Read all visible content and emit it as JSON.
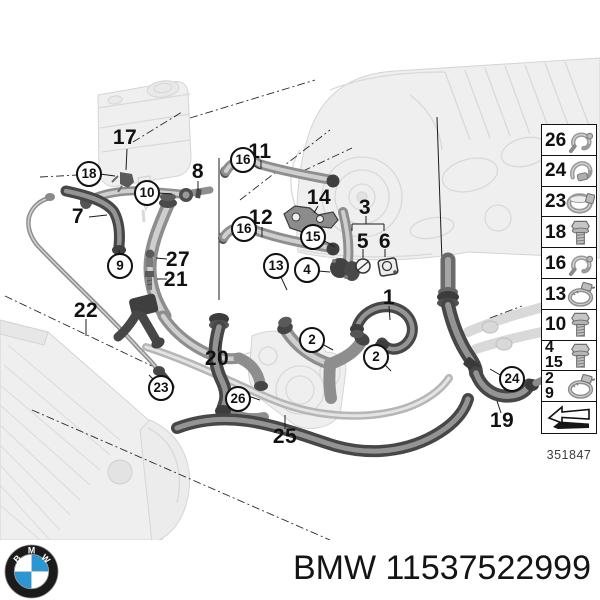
{
  "diagram": {
    "drawing_number": "351847",
    "callouts": [
      {
        "label": "17",
        "x": 125,
        "y": 138,
        "circled": false
      },
      {
        "label": "18",
        "x": 89,
        "y": 174,
        "circled": true
      },
      {
        "label": "10",
        "x": 147,
        "y": 193,
        "circled": true
      },
      {
        "label": "8",
        "x": 198,
        "y": 172,
        "circled": false
      },
      {
        "label": "7",
        "x": 78,
        "y": 217,
        "circled": false
      },
      {
        "label": "9",
        "x": 120,
        "y": 266,
        "circled": true
      },
      {
        "label": "27",
        "x": 178,
        "y": 260,
        "circled": false
      },
      {
        "label": "21",
        "x": 176,
        "y": 280,
        "circled": false
      },
      {
        "label": "22",
        "x": 86,
        "y": 311,
        "circled": false
      },
      {
        "label": "23",
        "x": 161,
        "y": 388,
        "circled": true
      },
      {
        "label": "20",
        "x": 217,
        "y": 359,
        "circled": false
      },
      {
        "label": "26",
        "x": 238,
        "y": 399,
        "circled": true
      },
      {
        "label": "25",
        "x": 285,
        "y": 437,
        "circled": false
      },
      {
        "label": "11",
        "x": 260,
        "y": 152,
        "circled": false
      },
      {
        "label": "16",
        "x": 243,
        "y": 160,
        "circled": true
      },
      {
        "label": "12",
        "x": 261,
        "y": 218,
        "circled": false
      },
      {
        "label": "16",
        "x": 244,
        "y": 229,
        "circled": true
      },
      {
        "label": "13",
        "x": 276,
        "y": 266,
        "circled": true
      },
      {
        "label": "14",
        "x": 319,
        "y": 198,
        "circled": false
      },
      {
        "label": "15",
        "x": 313,
        "y": 237,
        "circled": true
      },
      {
        "label": "3",
        "x": 365,
        "y": 208,
        "circled": false
      },
      {
        "label": "5",
        "x": 363,
        "y": 242,
        "circled": false
      },
      {
        "label": "6",
        "x": 385,
        "y": 242,
        "circled": false
      },
      {
        "label": "4",
        "x": 307,
        "y": 270,
        "circled": true
      },
      {
        "label": "1",
        "x": 389,
        "y": 298,
        "circled": false
      },
      {
        "label": "2",
        "x": 312,
        "y": 340,
        "circled": true
      },
      {
        "label": "2",
        "x": 376,
        "y": 357,
        "circled": true
      },
      {
        "label": "24",
        "x": 512,
        "y": 379,
        "circled": true
      },
      {
        "label": "19",
        "x": 502,
        "y": 421,
        "circled": false
      }
    ],
    "legend": {
      "boxes": [
        {
          "numbers": [
            "26"
          ],
          "icon": "retaining-clip-icon"
        },
        {
          "numbers": [
            "24"
          ],
          "icon": "mounting-clip-icon"
        },
        {
          "numbers": [
            "23"
          ],
          "icon": "hose-clamp-icon"
        },
        {
          "numbers": [
            "18"
          ],
          "icon": "bolt-icon"
        },
        {
          "numbers": [
            "16"
          ],
          "icon": "retaining-clip-icon"
        },
        {
          "numbers": [
            "13"
          ],
          "icon": "worm-clamp-icon"
        },
        {
          "numbers": [
            "10"
          ],
          "icon": "bolt-icon"
        },
        {
          "numbers": [
            "4",
            "15"
          ],
          "icon": "bolt-icon"
        },
        {
          "numbers": [
            "2",
            "9"
          ],
          "icon": "worm-clamp-icon"
        },
        {
          "numbers": [],
          "icon": "direction-arrow-icon"
        }
      ]
    }
  },
  "footer": {
    "text": "BMW 11537522999"
  },
  "logo": {
    "letters": [
      "B",
      "M",
      "W"
    ],
    "blue": "#2a97d4",
    "ring": "#1b1b1b"
  }
}
